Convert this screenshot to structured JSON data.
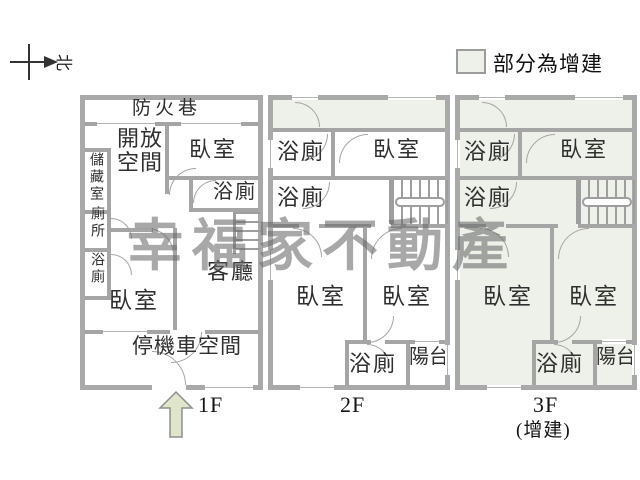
{
  "compass": {
    "north_label": "北"
  },
  "legend": {
    "label": "部分為增建",
    "swatch_color": "#edf1e9"
  },
  "watermark": {
    "text": "幸福家不動產"
  },
  "colors": {
    "wall": "#a9a9a9",
    "addition_fill": "#edf1e9",
    "arrow_fill": "#dfe5cb"
  },
  "floors": {
    "f1": {
      "name_label": "1F",
      "rooms": {
        "fire_lane": "防火巷",
        "open_space": "開放空間",
        "bedroom_top": "臥室",
        "bathroom_top": "浴廁",
        "storage": "儲藏室",
        "toilet": "廁所",
        "bathroom_left": "浴廁",
        "bedroom_bottom": "臥室",
        "living_room": "客廳",
        "parking": "停機車空間"
      }
    },
    "f2": {
      "name_label": "2F",
      "rooms": {
        "bathroom_1": "浴廁",
        "bedroom_top": "臥室",
        "bathroom_2": "浴廁",
        "bedroom_left": "臥室",
        "bedroom_right": "臥室",
        "bathroom_bottom": "浴廁",
        "balcony": "陽台"
      }
    },
    "f3": {
      "name_label": "3F",
      "sub_label": "(增建)",
      "rooms": {
        "bathroom_1": "浴廁",
        "bedroom_top": "臥室",
        "bathroom_2": "浴廁",
        "bedroom_left": "臥室",
        "bedroom_right": "臥室",
        "bathroom_bottom": "浴廁",
        "balcony": "陽台"
      }
    }
  }
}
